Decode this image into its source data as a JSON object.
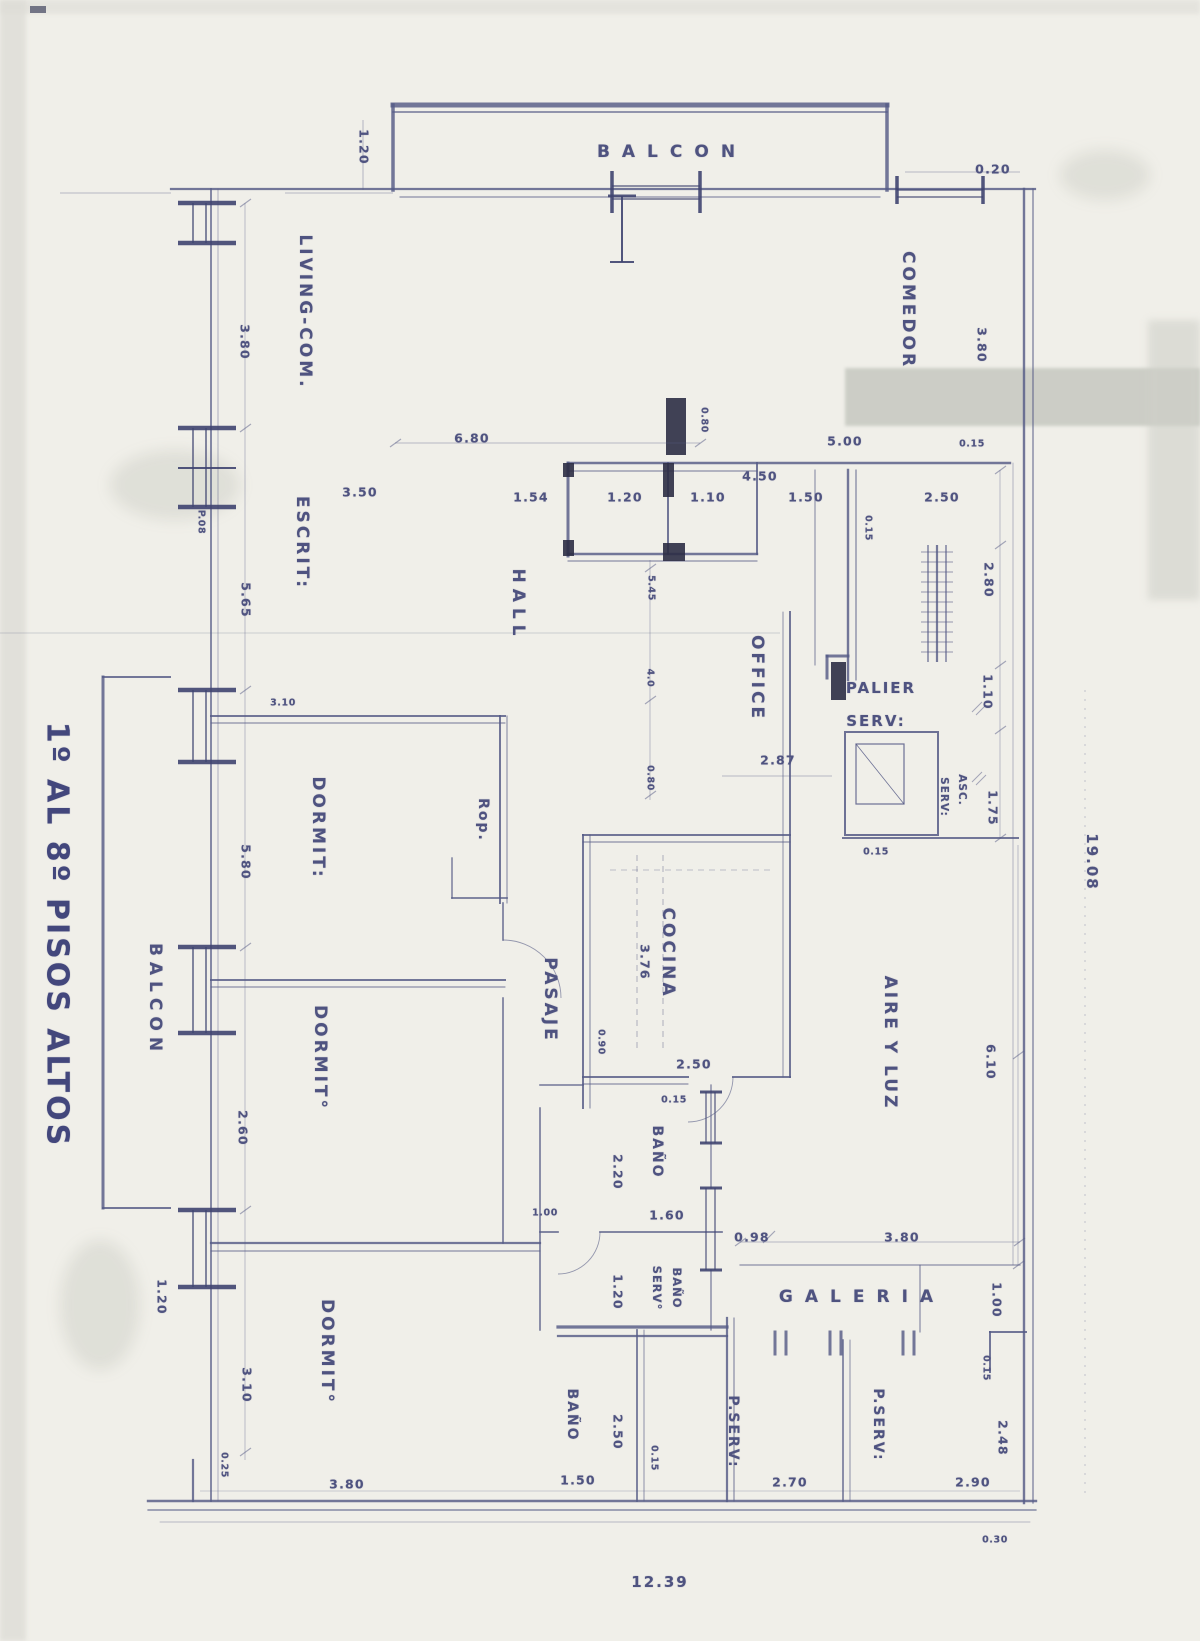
{
  "plan": {
    "title": "1º AL 8º PISOS ALTOS",
    "rooms": [
      {
        "label": "BALCON"
      },
      {
        "label": "COMEDOR"
      },
      {
        "label": "LIVING-COM."
      },
      {
        "label": "ESCRIT:"
      },
      {
        "label": "HALL"
      },
      {
        "label": "OFFICE"
      },
      {
        "label": "PALIER"
      },
      {
        "label": "SERV:"
      },
      {
        "label": "ASC."
      },
      {
        "label": "SERV:"
      },
      {
        "label": "Rop."
      },
      {
        "label": "DORMIT:"
      },
      {
        "label": "DORMIT°"
      },
      {
        "label": "DORMIT°"
      },
      {
        "label": "BALCON"
      },
      {
        "label": "PASAJE"
      },
      {
        "label": "COCINA"
      },
      {
        "label": "AIRE Y LUZ"
      },
      {
        "label": "BAÑO"
      },
      {
        "label": "BAÑO"
      },
      {
        "label": "SERV°"
      },
      {
        "label": "BAÑO"
      },
      {
        "label": "P.SERV:"
      },
      {
        "label": "P.SERV:"
      },
      {
        "label": "GALERIA"
      }
    ],
    "dimensions": [
      {
        "value": "1.20"
      },
      {
        "value": "0.20"
      },
      {
        "value": "3.80"
      },
      {
        "value": "3.80"
      },
      {
        "value": "3.50"
      },
      {
        "value": "5.65"
      },
      {
        "value": "6.80"
      },
      {
        "value": "1.54"
      },
      {
        "value": "1.20"
      },
      {
        "value": "1.10"
      },
      {
        "value": "0.80"
      },
      {
        "value": "4.50"
      },
      {
        "value": "5.00"
      },
      {
        "value": "0.15"
      },
      {
        "value": "1.50"
      },
      {
        "value": "2.50"
      },
      {
        "value": "0.15"
      },
      {
        "value": "2.80"
      },
      {
        "value": "1.10"
      },
      {
        "value": "1.75"
      },
      {
        "value": "0.15"
      },
      {
        "value": "5.45"
      },
      {
        "value": "4.0"
      },
      {
        "value": "0.80"
      },
      {
        "value": "2.87"
      },
      {
        "value": "19.08"
      },
      {
        "value": "6.10"
      },
      {
        "value": "5.80"
      },
      {
        "value": "2.60"
      },
      {
        "value": "0.90"
      },
      {
        "value": "2.50"
      },
      {
        "value": "0.15"
      },
      {
        "value": "2.20"
      },
      {
        "value": "1.60"
      },
      {
        "value": "1.00"
      },
      {
        "value": "1.20"
      },
      {
        "value": "0.98"
      },
      {
        "value": "3.80"
      },
      {
        "value": "1.00"
      },
      {
        "value": "0.15"
      },
      {
        "value": "2.48"
      },
      {
        "value": "2.90"
      },
      {
        "value": "0.30"
      },
      {
        "value": "2.70"
      },
      {
        "value": "1.50"
      },
      {
        "value": "2.50"
      },
      {
        "value": "0.15"
      },
      {
        "value": "3.10"
      },
      {
        "value": "0.25"
      },
      {
        "value": "3.80"
      },
      {
        "value": "12.39"
      },
      {
        "value": "1.20"
      },
      {
        "value": "P.08"
      },
      {
        "value": "3.10"
      },
      {
        "value": "3.76"
      }
    ],
    "ink_color": "#4f5380",
    "paper_color": "#f0efe9"
  }
}
